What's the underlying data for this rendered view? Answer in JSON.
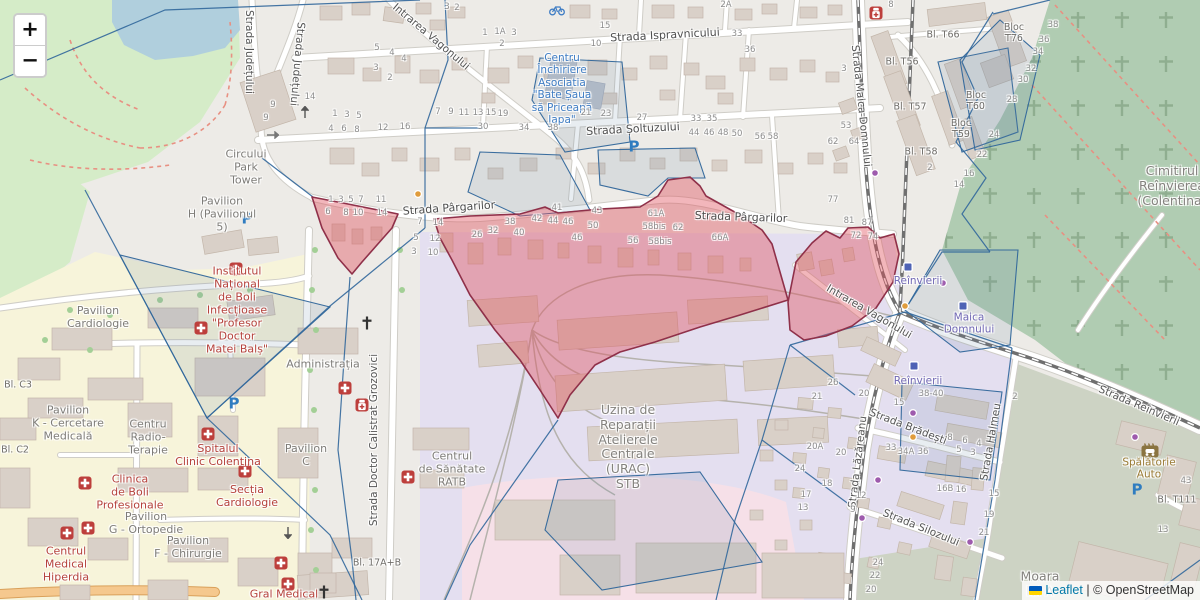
{
  "controls": {
    "zoom_in_label": "+",
    "zoom_out_label": "−"
  },
  "attribution": {
    "leaflet_label": "Leaflet",
    "separator": " | ",
    "osm_label": "© OpenStreetMap",
    "flag_top_color": "#005BBB",
    "flag_bottom_color": "#FFD500"
  },
  "colors": {
    "land": "#edebe7",
    "park": "#d5ecc8",
    "lake": "#b0cfdd",
    "campus": "#f7f4da",
    "industrial": "#e4dff0",
    "retail_pink": "#f6e0e8",
    "cemetery": "#b0ccb2",
    "olive": "#cdd3c4",
    "building": "#d9d0c8",
    "road": "#ffffff",
    "overlay_blue": "#31679b",
    "overlay_fill": "rgba(104,136,170,0.16)",
    "red_zone_fill": "rgba(223,80,92,0.42)",
    "red_zone_stroke": "#8f3049",
    "medical_text": "#b5423c",
    "shop_text": "#3f7dc4",
    "transit_text": "#7168b4",
    "street_text": "#4e4e4e",
    "number_text": "#8d8d8d",
    "link": "#0078A8"
  },
  "street_labels": [
    {
      "t": "Strada Ispravnicului",
      "x": 665,
      "y": 36,
      "r": -3,
      "cls": "street"
    },
    {
      "t": "Strada Șoltuzului",
      "x": 633,
      "y": 130,
      "r": -3,
      "cls": "street"
    },
    {
      "t": "Strada Pârgarilor",
      "x": 449,
      "y": 209,
      "r": -4,
      "cls": "street"
    },
    {
      "t": "Strada Pârgarilor",
      "x": 741,
      "y": 218,
      "r": 2,
      "cls": "street"
    },
    {
      "t": "Strada Județului",
      "x": 249,
      "y": 52,
      "r": 90,
      "cls": "street-v"
    },
    {
      "t": "Strada Județului",
      "x": 297,
      "y": 64,
      "r": 95,
      "cls": "street-v"
    },
    {
      "t": "Intrarea Vagonului",
      "x": 431,
      "y": 37,
      "r": 40,
      "cls": "street-v"
    },
    {
      "t": "Intrarea Vagonului",
      "x": 869,
      "y": 312,
      "r": 30,
      "cls": "street-v"
    },
    {
      "t": "Strada Doctor Calistrat Grozovici",
      "x": 374,
      "y": 440,
      "r": -90,
      "cls": "street-v"
    },
    {
      "t": "Strada Maica Domnului",
      "x": 861,
      "y": 106,
      "r": 84,
      "cls": "street-v"
    },
    {
      "t": "Strada Reînvierii",
      "x": 1139,
      "y": 406,
      "r": 23,
      "cls": "street-v"
    },
    {
      "t": "Strada Brădești",
      "x": 908,
      "y": 427,
      "r": 21,
      "cls": "street-v"
    },
    {
      "t": "Strada Silozului",
      "x": 921,
      "y": 528,
      "r": 22,
      "cls": "street-v"
    },
    {
      "t": "Strada Halmeu",
      "x": 991,
      "y": 442,
      "r": -80,
      "cls": "street-v"
    },
    {
      "t": "Strada Lăzăreanu",
      "x": 858,
      "y": 462,
      "r": -83,
      "cls": "street-v"
    }
  ],
  "area_labels": [
    {
      "t": "Circului\nPark\nTower",
      "x": 246,
      "y": 168,
      "cls": "area"
    },
    {
      "t": "Pavilion\nH (Pavilionul\n5)",
      "x": 222,
      "y": 215,
      "cls": "area"
    },
    {
      "t": "Pavilion\nCardiologie",
      "x": 98,
      "y": 318,
      "cls": "area"
    },
    {
      "t": "Administrația",
      "x": 323,
      "y": 365,
      "cls": "area"
    },
    {
      "t": "Pavilion\nK - Cercetare\nMedicală",
      "x": 68,
      "y": 424,
      "cls": "area"
    },
    {
      "t": "Centru\nRadio-\nTerapie",
      "x": 148,
      "y": 438,
      "cls": "area"
    },
    {
      "t": "Pavilion\nG - Ortopedie",
      "x": 146,
      "y": 524,
      "cls": "area"
    },
    {
      "t": "Pavilion\nF - Chirurgie",
      "x": 188,
      "y": 548,
      "cls": "area"
    },
    {
      "t": "Pavilion\nC",
      "x": 306,
      "y": 456,
      "cls": "area"
    },
    {
      "t": "Centrul\nde Sănătate\nRATB",
      "x": 452,
      "y": 470,
      "cls": "area"
    },
    {
      "t": "Uzina de\nReparații\nAtelierele\nCentrale\n(URAC)\nSTB",
      "x": 628,
      "y": 447,
      "cls": "area-lg"
    },
    {
      "t": "Cimitirul\nReînvierea\n(Colentina)",
      "x": 1172,
      "y": 186,
      "cls": "area-lg"
    },
    {
      "t": "Moara\nlui A",
      "x": 1040,
      "y": 584,
      "cls": "area-lg"
    },
    {
      "t": "Bl. C3",
      "x": 18,
      "y": 385,
      "cls": "block"
    },
    {
      "t": "Bl. C2",
      "x": 15,
      "y": 450,
      "cls": "block"
    },
    {
      "t": "Bl. 17A+B",
      "x": 377,
      "y": 563,
      "cls": "block"
    },
    {
      "t": "Bl. T66",
      "x": 943,
      "y": 35,
      "cls": "block"
    },
    {
      "t": "Bl. T56",
      "x": 902,
      "y": 62,
      "cls": "block"
    },
    {
      "t": "Bl. T57",
      "x": 910,
      "y": 107,
      "cls": "block"
    },
    {
      "t": "Bl. T58",
      "x": 921,
      "y": 152,
      "cls": "block"
    },
    {
      "t": "Bloc\nT76",
      "x": 1014,
      "y": 33,
      "cls": "block"
    },
    {
      "t": "Bloc\nT60",
      "x": 976,
      "y": 101,
      "cls": "block"
    },
    {
      "t": "Bloc\nT59",
      "x": 961,
      "y": 129,
      "cls": "block"
    },
    {
      "t": "Bl. T111",
      "x": 1177,
      "y": 500,
      "cls": "block"
    }
  ],
  "poi_labels": [
    {
      "t": "Institutul\nNațional\nde Boli\nInfecțioase\n\"Profesor\nDoctor\nMatei Balș\"",
      "x": 237,
      "y": 311,
      "cls": "medical"
    },
    {
      "t": "Spitalul\nClinic Colentina",
      "x": 218,
      "y": 456,
      "cls": "medical"
    },
    {
      "t": "Secția\nCardiologie",
      "x": 247,
      "y": 497,
      "cls": "medical"
    },
    {
      "t": "Clinica\nde Boli\nProfesionale",
      "x": 130,
      "y": 493,
      "cls": "medical"
    },
    {
      "t": "Centrul\nMedical\nHiperdia",
      "x": 66,
      "y": 565,
      "cls": "medical"
    },
    {
      "t": "Gral Medical",
      "x": 284,
      "y": 595,
      "cls": "medical"
    },
    {
      "t": "Centru\nÎnchiriere\nAsociatia\n\"Bate Șaua\nsă Priceapă\nIapa\"",
      "x": 562,
      "y": 89,
      "cls": "shop"
    },
    {
      "t": "Reînvierii",
      "x": 918,
      "y": 281,
      "cls": "transit"
    },
    {
      "t": "Reînvierii",
      "x": 918,
      "y": 381,
      "cls": "transit"
    },
    {
      "t": "Maica\nDomnului",
      "x": 969,
      "y": 324,
      "cls": "transit"
    },
    {
      "t": "Spălătorie\nAuto",
      "x": 1149,
      "y": 469,
      "cls": "carwash"
    }
  ],
  "house_numbers": [
    [
      "3",
      447,
      7
    ],
    [
      "2",
      457,
      8
    ],
    [
      "2A",
      726,
      5
    ],
    [
      "5",
      377,
      48
    ],
    [
      "4",
      392,
      53
    ],
    [
      "4",
      404,
      59
    ],
    [
      "3",
      376,
      68
    ],
    [
      "2",
      390,
      78
    ],
    [
      "14",
      310,
      97
    ],
    [
      "9",
      273,
      105
    ],
    [
      "9",
      266,
      118
    ],
    [
      "1",
      485,
      33
    ],
    [
      "1A",
      500,
      32
    ],
    [
      "3",
      514,
      33
    ],
    [
      "2",
      502,
      44
    ],
    [
      "15",
      605,
      26
    ],
    [
      "10",
      596,
      44
    ],
    [
      "33",
      737,
      34
    ],
    [
      "36",
      750,
      50
    ],
    [
      "7",
      438,
      112
    ],
    [
      "9",
      451,
      112
    ],
    [
      "11",
      464,
      113
    ],
    [
      "13",
      478,
      113
    ],
    [
      "15",
      491,
      113
    ],
    [
      "19",
      503,
      114
    ],
    [
      "21",
      586,
      113
    ],
    [
      "23",
      606,
      114
    ],
    [
      "27",
      642,
      118
    ],
    [
      "33",
      696,
      119
    ],
    [
      "35",
      712,
      119
    ],
    [
      "1",
      335,
      114
    ],
    [
      "3",
      347,
      115
    ],
    [
      "5",
      359,
      116
    ],
    [
      "4",
      331,
      129
    ],
    [
      "6",
      344,
      129
    ],
    [
      "8",
      357,
      130
    ],
    [
      "12",
      383,
      128
    ],
    [
      "16",
      405,
      127
    ],
    [
      "30",
      483,
      127
    ],
    [
      "34",
      524,
      128
    ],
    [
      "38",
      553,
      128
    ],
    [
      "44",
      694,
      133
    ],
    [
      "46",
      709,
      133
    ],
    [
      "48",
      723,
      133
    ],
    [
      "50",
      737,
      134
    ],
    [
      "56",
      760,
      137
    ],
    [
      "58",
      773,
      137
    ],
    [
      "62",
      833,
      142
    ],
    [
      "1",
      331,
      200
    ],
    [
      "3",
      341,
      200
    ],
    [
      "5",
      351,
      200
    ],
    [
      "7",
      361,
      200
    ],
    [
      "11",
      381,
      200
    ],
    [
      "41",
      557,
      208
    ],
    [
      "43",
      597,
      211
    ],
    [
      "61A",
      656,
      214
    ],
    [
      "77",
      833,
      200
    ],
    [
      "81",
      849,
      221
    ],
    [
      "87",
      867,
      223
    ],
    [
      "6",
      328,
      212
    ],
    [
      "8",
      346,
      213
    ],
    [
      "10",
      358,
      213
    ],
    [
      "14",
      382,
      213
    ],
    [
      "7",
      420,
      222
    ],
    [
      "14",
      438,
      223
    ],
    [
      "5",
      416,
      238
    ],
    [
      "12",
      435,
      239
    ],
    [
      "3",
      414,
      252
    ],
    [
      "10",
      433,
      253
    ],
    [
      "26",
      477,
      235
    ],
    [
      "32",
      493,
      231
    ],
    [
      "38",
      510,
      222
    ],
    [
      "40",
      519,
      233
    ],
    [
      "42",
      537,
      219
    ],
    [
      "44",
      553,
      221
    ],
    [
      "46",
      568,
      222
    ],
    [
      "50",
      593,
      226
    ],
    [
      "46",
      577,
      238
    ],
    [
      "58bis",
      654,
      227
    ],
    [
      "62",
      678,
      228
    ],
    [
      "56",
      633,
      241
    ],
    [
      "58bis",
      660,
      242
    ],
    [
      "66A",
      720,
      238
    ],
    [
      "72",
      856,
      236
    ],
    [
      "74",
      873,
      237
    ],
    [
      "8",
      891,
      5
    ],
    [
      "3",
      844,
      69
    ],
    [
      "53",
      846,
      126
    ],
    [
      "64",
      854,
      142
    ],
    [
      "2",
      930,
      168
    ],
    [
      "38",
      1053,
      25
    ],
    [
      "36",
      1044,
      40
    ],
    [
      "34",
      1038,
      52
    ],
    [
      "32",
      1031,
      69
    ],
    [
      "30",
      1023,
      80
    ],
    [
      "28",
      1012,
      100
    ],
    [
      "24",
      994,
      135
    ],
    [
      "22",
      982,
      155
    ],
    [
      "16",
      969,
      174
    ],
    [
      "14",
      959,
      185
    ],
    [
      "26",
      833,
      383
    ],
    [
      "21",
      817,
      397
    ],
    [
      "20",
      864,
      394
    ],
    [
      "15",
      899,
      403
    ],
    [
      "38-40",
      931,
      394
    ],
    [
      "2",
      1015,
      397
    ],
    [
      "20A",
      815,
      447
    ],
    [
      "20",
      841,
      453
    ],
    [
      "24",
      800,
      469
    ],
    [
      "18",
      827,
      484
    ],
    [
      "17",
      806,
      495
    ],
    [
      "13",
      803,
      508
    ],
    [
      "12",
      861,
      496
    ],
    [
      "9",
      853,
      510
    ],
    [
      "33",
      891,
      448
    ],
    [
      "34A",
      906,
      452
    ],
    [
      "36",
      923,
      452
    ],
    [
      "16B",
      945,
      489
    ],
    [
      "16",
      961,
      490
    ],
    [
      "8",
      950,
      438
    ],
    [
      "6",
      965,
      441
    ],
    [
      "4",
      979,
      444
    ],
    [
      "5",
      959,
      450
    ],
    [
      "3",
      973,
      453
    ],
    [
      "15",
      994,
      494
    ],
    [
      "19",
      989,
      515
    ],
    [
      "21",
      984,
      533
    ],
    [
      "24",
      878,
      563
    ],
    [
      "22",
      875,
      576
    ],
    [
      "20",
      871,
      590
    ],
    [
      "43",
      1186,
      481
    ],
    [
      "13",
      1163,
      530
    ]
  ],
  "icons": [
    {
      "type": "parking",
      "x": 634,
      "y": 147
    },
    {
      "type": "parking",
      "x": 247,
      "y": 219
    },
    {
      "type": "parking",
      "x": 234,
      "y": 404
    },
    {
      "type": "parking",
      "x": 1137,
      "y": 490
    },
    {
      "type": "hospital",
      "x": 236,
      "y": 269
    },
    {
      "type": "hospital",
      "x": 201,
      "y": 328
    },
    {
      "type": "hospital",
      "x": 208,
      "y": 434
    },
    {
      "type": "hospital",
      "x": 245,
      "y": 471
    },
    {
      "type": "hospital",
      "x": 85,
      "y": 483
    },
    {
      "type": "hospital",
      "x": 67,
      "y": 533
    },
    {
      "type": "hospital",
      "x": 88,
      "y": 528
    },
    {
      "type": "hospital",
      "x": 281,
      "y": 563
    },
    {
      "type": "hospital",
      "x": 288,
      "y": 584
    },
    {
      "type": "hospital",
      "x": 408,
      "y": 477
    },
    {
      "type": "hospital",
      "x": 345,
      "y": 388
    },
    {
      "type": "pharmacy",
      "x": 362,
      "y": 405
    },
    {
      "type": "pharmacy",
      "x": 876,
      "y": 13
    },
    {
      "type": "church",
      "x": 367,
      "y": 323
    },
    {
      "type": "church",
      "x": 324,
      "y": 592
    },
    {
      "type": "transit-stop",
      "x": 908,
      "y": 267
    },
    {
      "type": "transit-stop",
      "x": 914,
      "y": 366
    },
    {
      "type": "transit-stop",
      "x": 963,
      "y": 306
    },
    {
      "type": "dot-purple",
      "x": 943,
      "y": 283
    },
    {
      "type": "dot-purple",
      "x": 913,
      "y": 413
    },
    {
      "type": "dot-purple",
      "x": 878,
      "y": 480
    },
    {
      "type": "dot-purple",
      "x": 862,
      "y": 518
    },
    {
      "type": "dot-purple",
      "x": 970,
      "y": 542
    },
    {
      "type": "dot-purple",
      "x": 1135,
      "y": 437
    },
    {
      "type": "dot-purple",
      "x": 875,
      "y": 173
    },
    {
      "type": "dot-orange",
      "x": 905,
      "y": 306
    },
    {
      "type": "dot-orange",
      "x": 418,
      "y": 194
    },
    {
      "type": "dot-orange",
      "x": 913,
      "y": 437
    },
    {
      "type": "carwash",
      "x": 1150,
      "y": 450
    },
    {
      "type": "bicycle",
      "x": 557,
      "y": 10
    },
    {
      "type": "arrow-right",
      "x": 273,
      "y": 135
    },
    {
      "type": "arrow-up",
      "x": 305,
      "y": 112
    },
    {
      "type": "arrow-down",
      "x": 288,
      "y": 533
    }
  ]
}
